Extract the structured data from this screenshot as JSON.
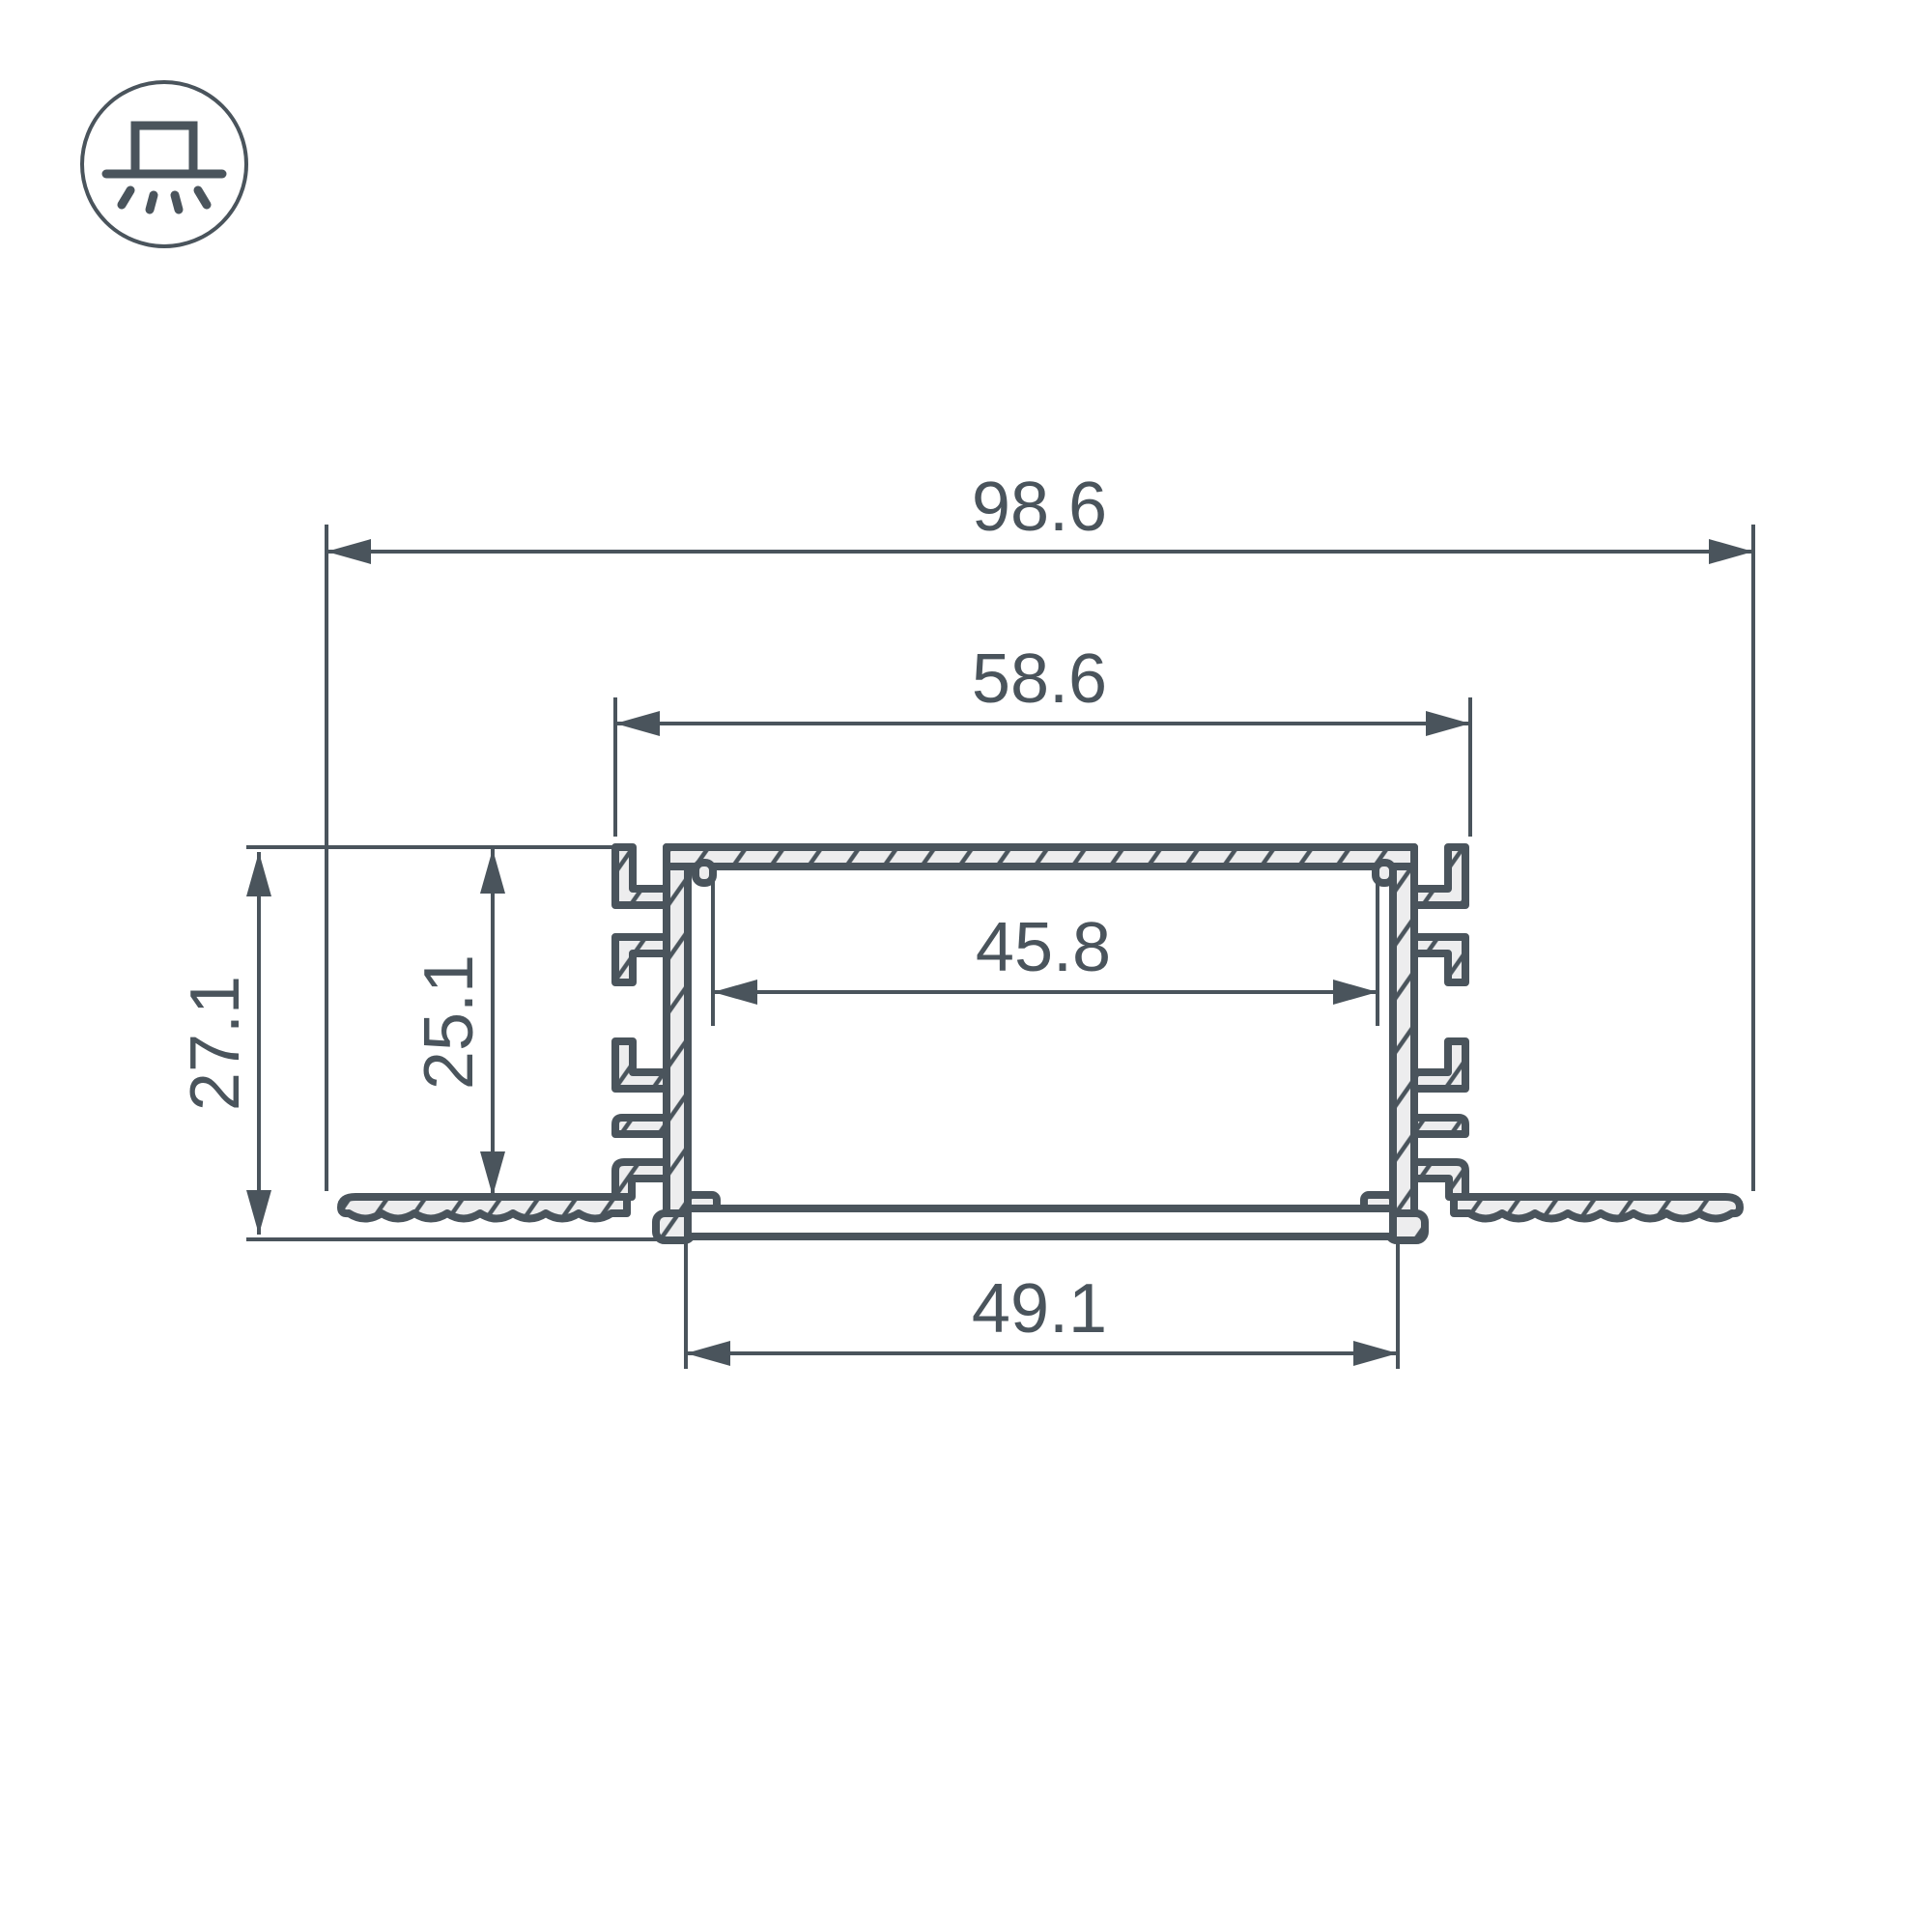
{
  "drawing": {
    "kind": "profile-cross-section",
    "icon": {
      "name": "recessed-downlight-icon"
    }
  },
  "colors": {
    "line": "#4a545c",
    "fill_light": "#ededee",
    "background": "#ffffff"
  },
  "dims": {
    "overall_width": "98.6",
    "mount_width": "58.6",
    "inner_width": "45.8",
    "cover_width": "49.1",
    "overall_height": "27.1",
    "inner_height": "25.1"
  }
}
